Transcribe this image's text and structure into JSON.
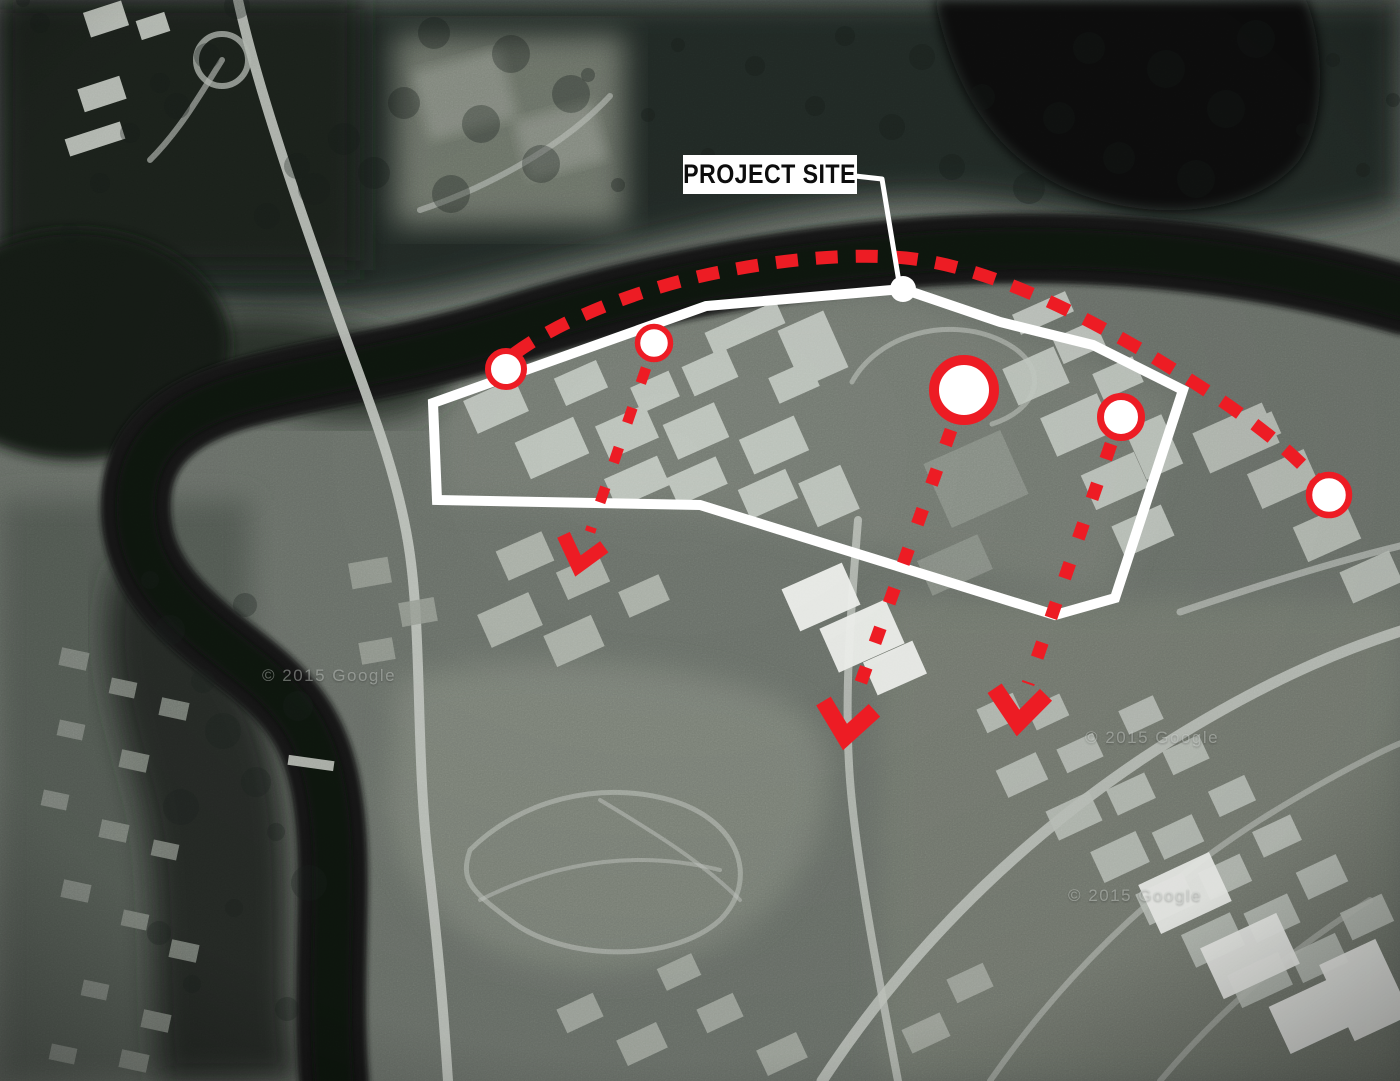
{
  "map": {
    "label": "PROJECT SITE",
    "watermark_text": "© 2015 Google"
  },
  "colors": {
    "accent_red": "#ed1c24",
    "overlay_white": "#ffffff",
    "label_bg": "#ffffff",
    "label_text": "#0d0d0d"
  },
  "overlay": {
    "site_boundary_points": "433,403 706,306 903,289 1000,322 1093,345 1183,390 1115,598 1055,615 700,505 437,500",
    "access_arc_path": "M 514 354 C 560 320 640 288 720 272 C 800 256 862 254 906 258 C 980 266 1058 302 1140 349 C 1228 402 1278 438 1316 479",
    "leader_points": "855,176 882,179 899,282",
    "site_dot": {
      "cx": 903,
      "cy": 289,
      "r": 13
    },
    "markers": [
      {
        "cx": 506,
        "cy": 369,
        "r": 18,
        "ring": 6
      },
      {
        "cx": 654,
        "cy": 343,
        "r": 16.5,
        "ring": 5.5
      },
      {
        "cx": 964,
        "cy": 390,
        "r": 30,
        "ring": 10
      },
      {
        "cx": 1121,
        "cy": 417,
        "r": 20.5,
        "ring": 7
      },
      {
        "cx": 1329,
        "cy": 495,
        "r": 20,
        "ring": 6.5
      }
    ],
    "routes": [
      {
        "x1": 646,
        "y1": 368,
        "x2": 590,
        "y2": 532,
        "tip": [
          578,
          566
        ],
        "rot": 14,
        "scale": 0.82
      },
      {
        "x1": 951,
        "y1": 430,
        "x2": 856,
        "y2": 696,
        "tip": [
          845,
          737
        ],
        "rot": 8,
        "scale": 1
      },
      {
        "x1": 1111,
        "y1": 444,
        "x2": 1028,
        "y2": 684,
        "tip": [
          1018,
          723
        ],
        "rot": 5,
        "scale": 1
      }
    ],
    "watermarks": [
      {
        "x": 262,
        "y": 666
      },
      {
        "x": 1085,
        "y": 728
      },
      {
        "x": 1068,
        "y": 886
      }
    ]
  }
}
